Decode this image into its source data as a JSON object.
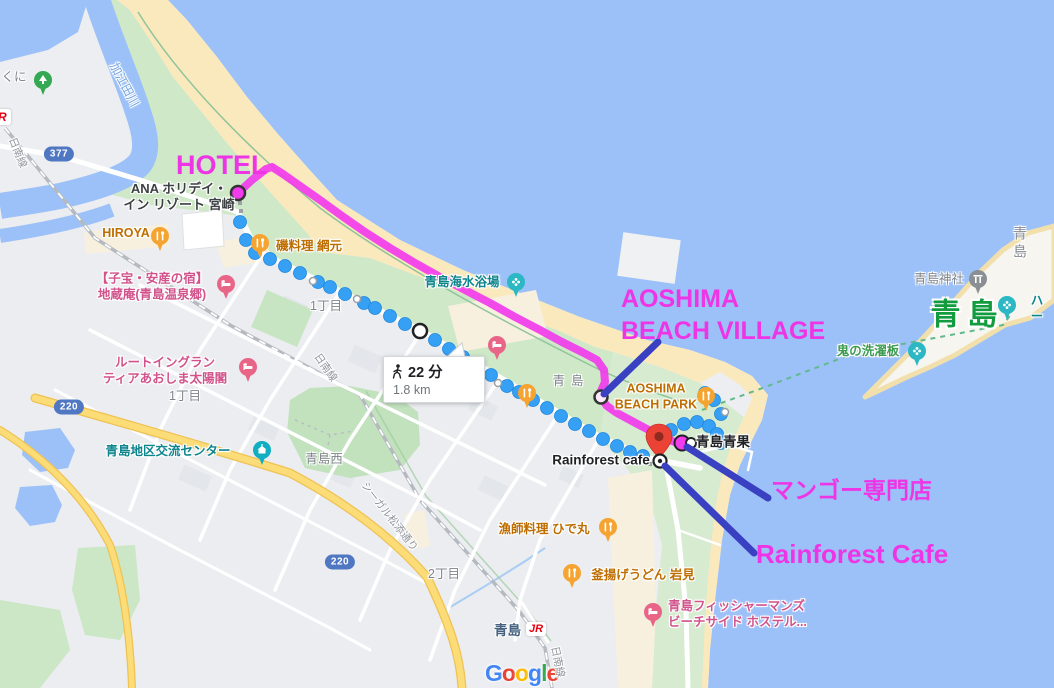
{
  "map": {
    "attribution_letters": [
      {
        "ch": "G",
        "color": "#4285F4"
      },
      {
        "ch": "o",
        "color": "#EA4335"
      },
      {
        "ch": "o",
        "color": "#FBBC05"
      },
      {
        "ch": "g",
        "color": "#4285F4"
      },
      {
        "ch": "l",
        "color": "#34A853"
      },
      {
        "ch": "e",
        "color": "#EA4335"
      }
    ],
    "walking_badge": {
      "duration": "22 分",
      "distance": "1.8 km",
      "icon": "walking-person-icon",
      "x": 383,
      "y": 356,
      "w": 84,
      "h": 46
    },
    "route_badges": [
      {
        "text": "377",
        "x": 59,
        "y": 154
      },
      {
        "text": "220",
        "x": 69,
        "y": 407
      },
      {
        "text": "220",
        "x": 340,
        "y": 562
      }
    ],
    "jr_partial_logo": {
      "text": "R",
      "x": -6,
      "y": 109
    },
    "station": {
      "name": "青島",
      "jr": "JR",
      "x": 494,
      "y": 619
    },
    "labels": [
      {
        "id": "kuni",
        "text": "くに",
        "x": 14,
        "y": 78,
        "style": "district"
      },
      {
        "id": "kaeda-river",
        "text": "加江田川",
        "x": 124,
        "y": 85,
        "style": "river",
        "rot": 62
      },
      {
        "id": "nichinan-line-1",
        "text": "日南線",
        "x": 17,
        "y": 153,
        "style": "road",
        "rot": 68
      },
      {
        "id": "hotel-ana",
        "text": "ANA ホリデイ・\nイン リゾート 宮崎",
        "x": 179,
        "y": 197,
        "style": "poi-dark",
        "poi": true
      },
      {
        "id": "hiroya",
        "text": "HIROYA",
        "x": 126,
        "y": 234,
        "style": "poi-orange",
        "poi": true
      },
      {
        "id": "iso-amimoto",
        "text": "磯料理 網元",
        "x": 309,
        "y": 247,
        "style": "poi-orange",
        "poi": true
      },
      {
        "id": "jizoan",
        "text": "【子宝・安産の宿】\n地蔵庵(青島温泉郷)",
        "x": 152,
        "y": 287,
        "style": "poi-pink",
        "poi": true
      },
      {
        "id": "itchome-1",
        "text": "1丁目",
        "x": 326,
        "y": 307,
        "style": "district"
      },
      {
        "id": "route-inn",
        "text": "ルートイングラン\nティアあおしま太陽閣",
        "x": 165,
        "y": 371,
        "style": "poi-pink",
        "poi": true
      },
      {
        "id": "itchome-2",
        "text": "1丁目",
        "x": 185,
        "y": 397,
        "style": "district"
      },
      {
        "id": "kaisuiyokujo",
        "text": "青島海水浴場",
        "x": 462,
        "y": 283,
        "style": "poi-teal",
        "poi": true
      },
      {
        "id": "aoshima-town",
        "text": "青島",
        "x": 568,
        "y": 382,
        "style": "district-sp"
      },
      {
        "id": "beach-park",
        "text": "AOSHIMA\nBEACH PARK",
        "x": 656,
        "y": 397,
        "style": "poi-orange",
        "poi": true
      },
      {
        "id": "aoshima-seika",
        "text": "青島青果",
        "x": 723,
        "y": 443,
        "style": "poi-black",
        "poi": true
      },
      {
        "id": "rainforest-poi",
        "text": "Rainforest cafe",
        "x": 601,
        "y": 461,
        "style": "poi-black",
        "poi": true
      },
      {
        "id": "koryu-center",
        "text": "青島地区交流センター",
        "x": 168,
        "y": 452,
        "style": "poi-teal",
        "poi": true
      },
      {
        "id": "aoshima-nishi",
        "text": "青島西",
        "x": 324,
        "y": 460,
        "style": "district"
      },
      {
        "id": "seagull-street",
        "text": "シーガル松添通り",
        "x": 389,
        "y": 517,
        "style": "road",
        "rot": 52
      },
      {
        "id": "nichinan-line-2",
        "text": "日南線",
        "x": 325,
        "y": 368,
        "style": "road",
        "rot": 55
      },
      {
        "id": "nichome",
        "text": "2丁目",
        "x": 444,
        "y": 575,
        "style": "district"
      },
      {
        "id": "hidemaru",
        "text": "漁師料理 ひで丸",
        "x": 544,
        "y": 530,
        "style": "poi-orange",
        "poi": true
      },
      {
        "id": "iwami",
        "text": "釜揚げうどん 岩見",
        "x": 643,
        "y": 576,
        "style": "poi-orange",
        "poi": true
      },
      {
        "id": "fishermans-hostel",
        "text": "青島フィッシャーマンズ\nビーチサイド ホステル...",
        "x": 668,
        "y": 599,
        "style": "poi-pink",
        "poi": true,
        "anchor": "tl"
      },
      {
        "id": "nichinan-line-3",
        "text": "日南線",
        "x": 557,
        "y": 662,
        "style": "road",
        "rot": 78
      },
      {
        "id": "aoshima-island-gray",
        "text": "青島",
        "x": 1020,
        "y": 243,
        "style": "island"
      },
      {
        "id": "aoshima-jinja",
        "text": "青島神社",
        "x": 939,
        "y": 280,
        "style": "district",
        "poi": true
      },
      {
        "id": "aoshima-island-green",
        "text": "青島",
        "x": 964,
        "y": 315,
        "style": "green-big"
      },
      {
        "id": "ha-truncated",
        "text": "ハー",
        "x": 1037,
        "y": 309,
        "style": "poi-teal",
        "poi": true
      },
      {
        "id": "oni-no-sentakuita",
        "text": "鬼の洗濯板",
        "x": 868,
        "y": 352,
        "style": "nature",
        "poi": true
      }
    ],
    "pins": [
      {
        "type": "tree",
        "x": 43,
        "y": 80
      },
      {
        "type": "food",
        "x": 160,
        "y": 236
      },
      {
        "type": "food",
        "x": 260,
        "y": 243
      },
      {
        "type": "lodging",
        "x": 226,
        "y": 284
      },
      {
        "type": "lodging",
        "x": 248,
        "y": 367
      },
      {
        "type": "lodging",
        "x": 497,
        "y": 345
      },
      {
        "type": "beach",
        "x": 516,
        "y": 282
      },
      {
        "type": "food",
        "x": 527,
        "y": 393
      },
      {
        "type": "food",
        "x": 608,
        "y": 527
      },
      {
        "type": "food",
        "x": 572,
        "y": 573
      },
      {
        "type": "food",
        "x": 706,
        "y": 396
      },
      {
        "type": "lodging",
        "x": 653,
        "y": 612
      },
      {
        "type": "civic",
        "x": 262,
        "y": 450
      },
      {
        "type": "shrine",
        "x": 978,
        "y": 279
      },
      {
        "type": "attraction",
        "x": 1007,
        "y": 305
      },
      {
        "type": "attraction",
        "x": 917,
        "y": 351
      }
    ],
    "seika_dot": {
      "x": 691,
      "y": 443
    },
    "destination": {
      "pin_x": 659,
      "pin_y": 441,
      "target_x": 660,
      "target_y": 461
    }
  },
  "annotations": {
    "color": "#EE35E5",
    "arrow_color": "#3A40C2",
    "items": [
      {
        "id": "hotel",
        "text": "HOTEL",
        "x": 176,
        "y": 148,
        "size": 27
      },
      {
        "id": "aoshima-beach-village",
        "text": "AOSHIMA\nBEACH VILLAGE",
        "x": 621,
        "y": 284,
        "size": 25
      },
      {
        "id": "mango-shop",
        "text": "マンゴー専門店",
        "x": 771,
        "y": 476,
        "size": 23
      },
      {
        "id": "rainforest-cafe",
        "text": "Rainforest Cafe",
        "x": 756,
        "y": 538,
        "size": 26
      }
    ],
    "arrows": [
      {
        "x1": 658,
        "y1": 342,
        "x2": 604,
        "y2": 394
      },
      {
        "x1": 768,
        "y1": 498,
        "x2": 687,
        "y2": 447
      },
      {
        "x1": 754,
        "y1": 553,
        "x2": 665,
        "y2": 466
      }
    ],
    "drawn_route": {
      "color": "#F13BEC",
      "points": [
        [
          238,
          193
        ],
        [
          252,
          180
        ],
        [
          266,
          169
        ],
        [
          272,
          167
        ],
        [
          283,
          174
        ],
        [
          300,
          186
        ],
        [
          320,
          200
        ],
        [
          342,
          216
        ],
        [
          365,
          232
        ],
        [
          390,
          248
        ],
        [
          415,
          263
        ],
        [
          440,
          277
        ],
        [
          465,
          290
        ],
        [
          490,
          303
        ],
        [
          515,
          317
        ],
        [
          540,
          330
        ],
        [
          562,
          342
        ],
        [
          582,
          352
        ],
        [
          597,
          360
        ],
        [
          604,
          370
        ],
        [
          605,
          382
        ],
        [
          601,
          391
        ],
        [
          601,
          398
        ],
        [
          607,
          406
        ],
        [
          617,
          413
        ],
        [
          630,
          420
        ],
        [
          645,
          428
        ],
        [
          660,
          436
        ],
        [
          672,
          441
        ],
        [
          680,
          444
        ]
      ]
    },
    "start_dot": {
      "x": 238,
      "y": 193
    },
    "village_dot": {
      "x": 601,
      "y": 397
    },
    "shop_dot": {
      "x": 682,
      "y": 443
    }
  },
  "walking_route": {
    "dot_color": "#36A0F5",
    "dots": [
      [
        240,
        222
      ],
      [
        246,
        240
      ],
      [
        255,
        253
      ],
      [
        270,
        259
      ],
      [
        285,
        266
      ],
      [
        300,
        273
      ],
      [
        318,
        282
      ],
      [
        330,
        287
      ],
      [
        345,
        294
      ],
      [
        364,
        303
      ],
      [
        375,
        308
      ],
      [
        390,
        316
      ],
      [
        405,
        324
      ],
      [
        435,
        340
      ],
      [
        449,
        349
      ],
      [
        463,
        357
      ],
      [
        477,
        366
      ],
      [
        491,
        375
      ],
      [
        507,
        386
      ],
      [
        519,
        392
      ],
      [
        533,
        400
      ],
      [
        547,
        408
      ],
      [
        561,
        416
      ],
      [
        575,
        424
      ],
      [
        589,
        431
      ],
      [
        603,
        439
      ],
      [
        617,
        446
      ],
      [
        630,
        452
      ],
      [
        643,
        456
      ],
      [
        658,
        438
      ],
      [
        671,
        430
      ],
      [
        684,
        424
      ],
      [
        697,
        422
      ],
      [
        709,
        426
      ],
      [
        717,
        434
      ],
      [
        721,
        443
      ],
      [
        721,
        414
      ],
      [
        714,
        400
      ],
      [
        705,
        393
      ]
    ],
    "mini_dots": [
      [
        313,
        281
      ],
      [
        357,
        299
      ],
      [
        498,
        383
      ],
      [
        725,
        412
      ]
    ],
    "via_dot": {
      "x": 420,
      "y": 331
    },
    "connector_dots": [
      [
        240,
        203
      ],
      [
        241,
        211
      ],
      [
        650,
        464
      ]
    ]
  },
  "ferry_dashed_line": {
    "color": "#62B98E",
    "points": [
      [
        702,
        410
      ],
      [
        760,
        389
      ],
      [
        810,
        370
      ],
      [
        855,
        353
      ],
      [
        897,
        345
      ],
      [
        940,
        337
      ],
      [
        1003,
        325
      ],
      [
        1012,
        313
      ]
    ]
  }
}
